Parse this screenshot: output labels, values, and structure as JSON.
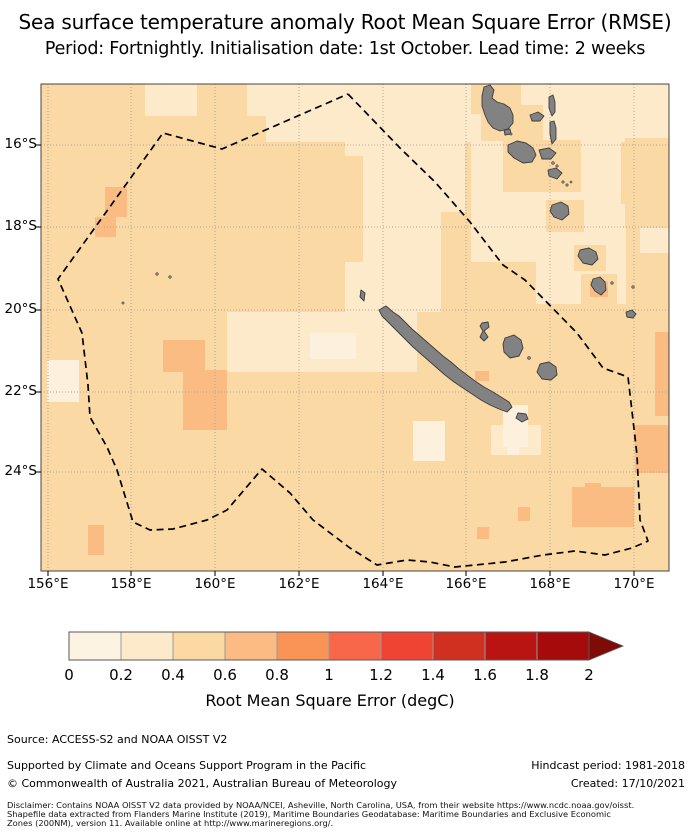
{
  "title": {
    "line1": "Sea surface temperature anomaly Root Mean Square Error (RMSE)",
    "line2": "Period: Fortnightly. Initialisation date: 1st October. Lead time: 2 weeks"
  },
  "map": {
    "x_ticks": [
      {
        "label": "156°E",
        "pos": 7
      },
      {
        "label": "158°E",
        "pos": 90
      },
      {
        "label": "160°E",
        "pos": 174
      },
      {
        "label": "162°E",
        "pos": 258
      },
      {
        "label": "164°E",
        "pos": 342
      },
      {
        "label": "166°E",
        "pos": 425
      },
      {
        "label": "168°E",
        "pos": 509
      },
      {
        "label": "170°E",
        "pos": 593
      }
    ],
    "y_ticks": [
      {
        "label": "16°S",
        "pos": 61
      },
      {
        "label": "18°S",
        "pos": 143
      },
      {
        "label": "20°S",
        "pos": 226
      },
      {
        "label": "22°S",
        "pos": 308
      },
      {
        "label": "24°S",
        "pos": 388
      }
    ],
    "colors": {
      "bin0": "#fdf0dc",
      "bin1": "#fdeaca",
      "bin2": "#fbd9a4",
      "bin3": "#fbbc84",
      "land": "#828282",
      "land_edge": "#3c3c3c",
      "grid": "#b3a896",
      "boundary": "#000000",
      "frame": "#444444"
    },
    "base_bin": "bin2",
    "cells": [
      {
        "bin": "bin1",
        "r": [
          206,
          0,
          422,
          32
        ]
      },
      {
        "bin": "bin1",
        "r": [
          225,
          32,
          403,
          26
        ]
      },
      {
        "bin": "bin1",
        "r": [
          104,
          0,
          52,
          32
        ]
      },
      {
        "bin": "bin1",
        "r": [
          279,
          87,
          28,
          60
        ]
      },
      {
        "bin": "bin1",
        "r": [
          304,
          58,
          120,
          70
        ]
      },
      {
        "bin": "bin1",
        "r": [
          304,
          128,
          96,
          100
        ]
      },
      {
        "bin": "bin1",
        "r": [
          186,
          228,
          190,
          60
        ]
      },
      {
        "bin": "bin1",
        "r": [
          430,
          58,
          150,
          120
        ]
      },
      {
        "bin": "bin1",
        "r": [
          495,
          120,
          90,
          100
        ]
      },
      {
        "bin": "bin1",
        "r": [
          599,
          131,
          29,
          38
        ]
      },
      {
        "bin": "bin1",
        "r": [
          450,
          341,
          50,
          30
        ]
      },
      {
        "bin": "bin2",
        "r": [
          246,
          72,
          76,
          106
        ]
      },
      {
        "bin": "bin2",
        "r": [
          430,
          0,
          50,
          30
        ]
      },
      {
        "bin": "bin2",
        "r": [
          440,
          21,
          62,
          36
        ]
      },
      {
        "bin": "bin2",
        "r": [
          462,
          56,
          78,
          52
        ]
      },
      {
        "bin": "bin2",
        "r": [
          505,
          116,
          38,
          32
        ]
      },
      {
        "bin": "bin2",
        "r": [
          533,
          161,
          32,
          26
        ]
      },
      {
        "bin": "bin2",
        "r": [
          584,
          54,
          44,
          90
        ]
      },
      {
        "bin": "bin2",
        "r": [
          540,
          190,
          36,
          30
        ]
      },
      {
        "bin": "bin0",
        "r": [
          269,
          249,
          46,
          26
        ]
      },
      {
        "bin": "bin0",
        "r": [
          6,
          276,
          32,
          42
        ]
      },
      {
        "bin": "bin0",
        "r": [
          372,
          337,
          32,
          40
        ]
      },
      {
        "bin": "bin0",
        "r": [
          462,
          321,
          25,
          42
        ]
      },
      {
        "bin": "bin0",
        "r": [
          466,
          354,
          12,
          17
        ]
      },
      {
        "bin": "bin3",
        "r": [
          64,
          103,
          22,
          30
        ]
      },
      {
        "bin": "bin3",
        "r": [
          54,
          133,
          21,
          20
        ]
      },
      {
        "bin": "bin3",
        "r": [
          122,
          256,
          42,
          32
        ]
      },
      {
        "bin": "bin3",
        "r": [
          142,
          286,
          44,
          60
        ]
      },
      {
        "bin": "bin3",
        "r": [
          614,
          248,
          14,
          84
        ]
      },
      {
        "bin": "bin3",
        "r": [
          594,
          341,
          34,
          48
        ]
      },
      {
        "bin": "bin3",
        "r": [
          531,
          403,
          62,
          40
        ]
      },
      {
        "bin": "bin3",
        "r": [
          544,
          399,
          16,
          14
        ]
      },
      {
        "bin": "bin3",
        "r": [
          477,
          423,
          12,
          14
        ]
      },
      {
        "bin": "bin3",
        "r": [
          436,
          443,
          12,
          12
        ]
      },
      {
        "bin": "bin3",
        "r": [
          47,
          441,
          16,
          30
        ]
      },
      {
        "bin": "bin3",
        "r": [
          434,
          287,
          14,
          10
        ]
      },
      {
        "bin": "bin3",
        "r": [
          549,
          197,
          18,
          16
        ]
      }
    ],
    "eez_boundary": [
      [
        307,
        10
      ],
      [
        359,
        64
      ],
      [
        394,
        98
      ],
      [
        429,
        138
      ],
      [
        462,
        181
      ],
      [
        484,
        196
      ],
      [
        536,
        249
      ],
      [
        562,
        284
      ],
      [
        587,
        293
      ],
      [
        592,
        336
      ],
      [
        596,
        371
      ],
      [
        599,
        436
      ],
      [
        607,
        457
      ],
      [
        591,
        464
      ],
      [
        564,
        471
      ],
      [
        534,
        467
      ],
      [
        502,
        471
      ],
      [
        464,
        478
      ],
      [
        414,
        483
      ],
      [
        389,
        478
      ],
      [
        366,
        476
      ],
      [
        336,
        481
      ],
      [
        309,
        464
      ],
      [
        272,
        436
      ],
      [
        249,
        409
      ],
      [
        221,
        385
      ],
      [
        186,
        426
      ],
      [
        166,
        436
      ],
      [
        132,
        445
      ],
      [
        109,
        446
      ],
      [
        92,
        438
      ],
      [
        76,
        386
      ],
      [
        66,
        363
      ],
      [
        49,
        333
      ],
      [
        47,
        301
      ],
      [
        41,
        249
      ],
      [
        17,
        195
      ],
      [
        122,
        49
      ],
      [
        181,
        65
      ],
      [
        307,
        10
      ]
    ],
    "islands": [
      {
        "name": "grande-terre",
        "pts": [
          [
            338,
            226
          ],
          [
            345,
            222
          ],
          [
            352,
            228
          ],
          [
            358,
            232
          ],
          [
            364,
            238
          ],
          [
            371,
            245
          ],
          [
            378,
            251
          ],
          [
            386,
            258
          ],
          [
            394,
            265
          ],
          [
            402,
            272
          ],
          [
            410,
            278
          ],
          [
            418,
            285
          ],
          [
            426,
            291
          ],
          [
            434,
            297
          ],
          [
            443,
            303
          ],
          [
            452,
            308
          ],
          [
            460,
            313
          ],
          [
            468,
            318
          ],
          [
            471,
            323
          ],
          [
            466,
            328
          ],
          [
            458,
            325
          ],
          [
            449,
            321
          ],
          [
            440,
            316
          ],
          [
            431,
            310
          ],
          [
            422,
            304
          ],
          [
            413,
            298
          ],
          [
            404,
            291
          ],
          [
            396,
            284
          ],
          [
            388,
            277
          ],
          [
            380,
            270
          ],
          [
            372,
            263
          ],
          [
            364,
            255
          ],
          [
            356,
            247
          ],
          [
            348,
            239
          ],
          [
            341,
            232
          ]
        ]
      },
      {
        "name": "belep",
        "pts": [
          [
            320,
            206
          ],
          [
            324,
            209
          ],
          [
            323,
            217
          ],
          [
            319,
            213
          ]
        ]
      },
      {
        "name": "isle-of-pines",
        "pts": [
          [
            477,
            329
          ],
          [
            485,
            330
          ],
          [
            487,
            335
          ],
          [
            481,
            338
          ],
          [
            475,
            334
          ]
        ]
      },
      {
        "name": "ouvea",
        "pts": [
          [
            441,
            239
          ],
          [
            447,
            238
          ],
          [
            448,
            243
          ],
          [
            443,
            247
          ],
          [
            447,
            253
          ],
          [
            443,
            257
          ],
          [
            439,
            253
          ],
          [
            442,
            247
          ],
          [
            439,
            242
          ]
        ]
      },
      {
        "name": "lifou",
        "pts": [
          [
            464,
            254
          ],
          [
            473,
            251
          ],
          [
            480,
            256
          ],
          [
            482,
            264
          ],
          [
            478,
            272
          ],
          [
            469,
            274
          ],
          [
            463,
            268
          ],
          [
            462,
            260
          ]
        ]
      },
      {
        "name": "mare",
        "pts": [
          [
            499,
            280
          ],
          [
            508,
            278
          ],
          [
            515,
            283
          ],
          [
            516,
            291
          ],
          [
            510,
            296
          ],
          [
            501,
            295
          ],
          [
            496,
            288
          ]
        ]
      },
      {
        "name": "espiritu-santo",
        "pts": [
          [
            443,
            3
          ],
          [
            449,
            1
          ],
          [
            453,
            6
          ],
          [
            451,
            14
          ],
          [
            456,
            18
          ],
          [
            463,
            20
          ],
          [
            469,
            24
          ],
          [
            472,
            31
          ],
          [
            472,
            39
          ],
          [
            467,
            45
          ],
          [
            459,
            47
          ],
          [
            452,
            44
          ],
          [
            447,
            38
          ],
          [
            444,
            31
          ],
          [
            441,
            22
          ],
          [
            441,
            12
          ]
        ]
      },
      {
        "name": "malo",
        "pts": [
          [
            463,
            46
          ],
          [
            469,
            45
          ],
          [
            470,
            50
          ],
          [
            464,
            51
          ]
        ]
      },
      {
        "name": "maewo",
        "pts": [
          [
            508,
            13
          ],
          [
            512,
            11
          ],
          [
            514,
            18
          ],
          [
            514,
            28
          ],
          [
            511,
            32
          ],
          [
            508,
            24
          ]
        ]
      },
      {
        "name": "ambae",
        "pts": [
          [
            489,
            31
          ],
          [
            497,
            28
          ],
          [
            503,
            32
          ],
          [
            499,
            37
          ],
          [
            491,
            37
          ]
        ]
      },
      {
        "name": "pentecost",
        "pts": [
          [
            509,
            38
          ],
          [
            513,
            37
          ],
          [
            515,
            44
          ],
          [
            515,
            55
          ],
          [
            511,
            60
          ],
          [
            509,
            50
          ]
        ]
      },
      {
        "name": "malakula",
        "pts": [
          [
            467,
            61
          ],
          [
            476,
            57
          ],
          [
            485,
            59
          ],
          [
            492,
            64
          ],
          [
            495,
            71
          ],
          [
            491,
            78
          ],
          [
            482,
            79
          ],
          [
            473,
            74
          ],
          [
            467,
            68
          ]
        ]
      },
      {
        "name": "ambrym",
        "pts": [
          [
            498,
            66
          ],
          [
            508,
            64
          ],
          [
            515,
            69
          ],
          [
            510,
            75
          ],
          [
            501,
            75
          ]
        ]
      },
      {
        "name": "epi",
        "pts": [
          [
            507,
            86
          ],
          [
            515,
            84
          ],
          [
            521,
            89
          ],
          [
            516,
            95
          ],
          [
            508,
            92
          ]
        ]
      },
      {
        "name": "efate",
        "pts": [
          [
            511,
            121
          ],
          [
            520,
            118
          ],
          [
            527,
            122
          ],
          [
            528,
            130
          ],
          [
            521,
            136
          ],
          [
            513,
            133
          ],
          [
            509,
            127
          ]
        ]
      },
      {
        "name": "erromango",
        "pts": [
          [
            539,
            166
          ],
          [
            548,
            164
          ],
          [
            555,
            168
          ],
          [
            557,
            175
          ],
          [
            551,
            181
          ],
          [
            542,
            179
          ],
          [
            537,
            172
          ]
        ]
      },
      {
        "name": "tanna",
        "pts": [
          [
            552,
            195
          ],
          [
            559,
            193
          ],
          [
            564,
            198
          ],
          [
            565,
            206
          ],
          [
            560,
            211
          ],
          [
            554,
            207
          ],
          [
            550,
            201
          ]
        ]
      },
      {
        "name": "aneityum",
        "pts": [
          [
            585,
            228
          ],
          [
            591,
            226
          ],
          [
            595,
            230
          ],
          [
            592,
            234
          ],
          [
            586,
            233
          ]
        ]
      }
    ],
    "islet_dots": [
      [
        512,
        79,
        1.5
      ],
      [
        516,
        82,
        1.3
      ],
      [
        522,
        98,
        1.3
      ],
      [
        526,
        101,
        1.3
      ],
      [
        530,
        98,
        1.1
      ],
      [
        571,
        199,
        1.4
      ],
      [
        592,
        203,
        1.4
      ],
      [
        488,
        274,
        1.6
      ],
      [
        470,
        50,
        1.2
      ],
      [
        116,
        190,
        1.4
      ],
      [
        129,
        193,
        1.4
      ],
      [
        82,
        219,
        1.2
      ]
    ]
  },
  "colorbar": {
    "tick_labels": [
      "0",
      "0.2",
      "0.4",
      "0.6",
      "0.8",
      "1",
      "1.2",
      "1.4",
      "1.6",
      "1.8",
      "2"
    ],
    "segment_colors": [
      "#fdf3e3",
      "#fdeaca",
      "#fcd9a2",
      "#fbbb82",
      "#f99356",
      "#f9674a",
      "#ef4433",
      "#d0301f",
      "#b91411",
      "#a50b0a"
    ],
    "arrow_color": "#7f0b06",
    "edge_color": "#5a5a5a",
    "caption": "Root Mean Square Error (degC)"
  },
  "footer": {
    "source": "Source: ACCESS-S2 and NOAA OISST V2",
    "supported": "Supported by Climate and Oceans Support Program in the Pacific",
    "copyright": "© Commonwealth of Australia 2021, Australian Bureau of Meteorology",
    "hindcast": "Hindcast period: 1981-2018",
    "created": "Created: 17/10/2021",
    "disclaimer_line1": "Disclaimer: Contains NOAA OISST V2 data provided by NOAA/NCEI, Asheville, North Carolina, USA, from their website https://www.ncdc.noaa.gov/oisst.",
    "disclaimer_line2": "Shapefile data extracted from Flanders Marine Institute (2019), Maritime Boundaries Geodatabase: Maritime Boundaries and Exclusive Economic",
    "disclaimer_line3": "Zones (200NM), version 11. Available online at http://www.marineregions.org/."
  }
}
